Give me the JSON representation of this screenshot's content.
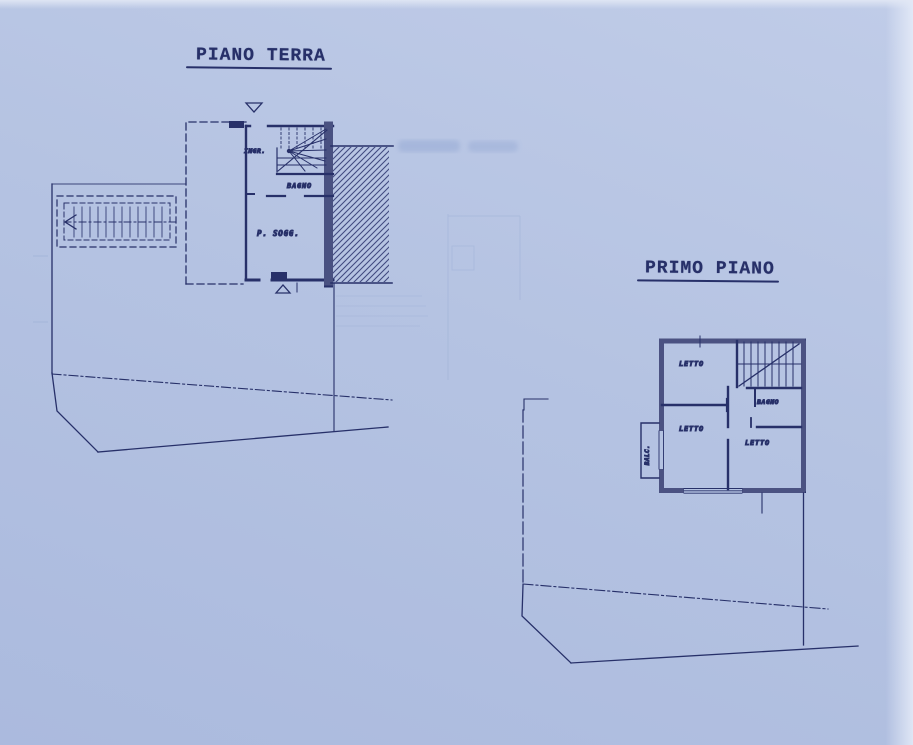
{
  "titles": {
    "ground_floor": "PIANO TERRA",
    "first_floor": "PRIMO PIANO"
  },
  "ground_floor": {
    "rooms": {
      "entrance": "INGR.",
      "bathroom": "BAGNO",
      "living": "P. SOGG."
    }
  },
  "first_floor": {
    "rooms": {
      "bedroom1": "LETTO",
      "bedroom2": "LETTO",
      "bedroom3": "LETTO",
      "bathroom": "BAGNO",
      "balcony": "BALC."
    }
  },
  "colors": {
    "paper": "#b5c3e2",
    "ink": "#273069",
    "faint": "#97aad3"
  }
}
